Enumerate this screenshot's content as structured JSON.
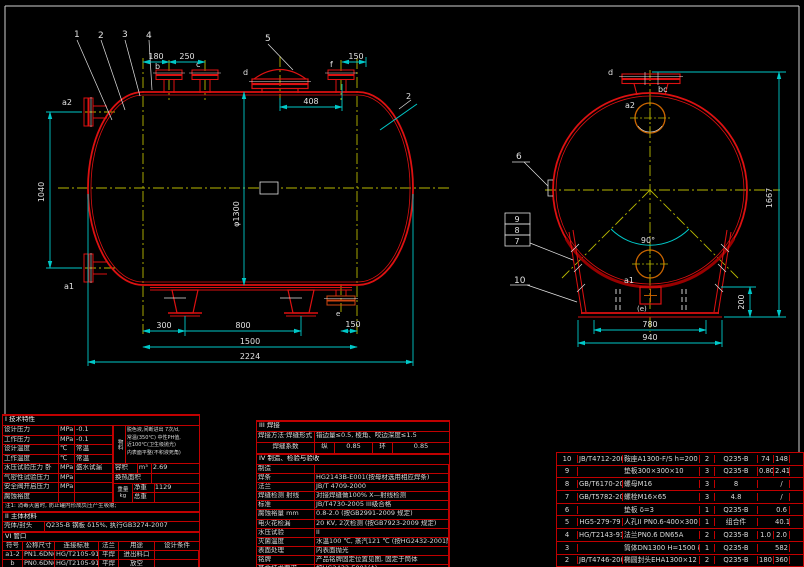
{
  "front": {
    "part_labels": {
      "n1": "1",
      "n2": "2",
      "n3": "3",
      "n4": "4",
      "n5": "5"
    },
    "nozzle_labels": {
      "a2": "a2",
      "a1": "a1",
      "b": "b",
      "c": "c",
      "d": "d",
      "f": "f",
      "e": "e"
    },
    "weld_callout": "2",
    "dims": {
      "top1": "180",
      "top2": "250",
      "mid": "408",
      "top3": "150",
      "left": "1040",
      "dia": "φ1300",
      "bot1": "300",
      "bot2": "800",
      "bot3": "150",
      "bot4": "1500",
      "bot5": "2224"
    }
  },
  "side": {
    "labels": {
      "d": "d",
      "bc": "bc",
      "a2": "a2",
      "a1": "a1",
      "e": "(e)",
      "n6": "6",
      "n7": "7",
      "n8": "8",
      "n9": "9",
      "n10": "10",
      "angle": "90°"
    },
    "dims": {
      "h": "1667",
      "saddle_h": "200",
      "w1": "780",
      "w2": "940"
    }
  },
  "tech": {
    "title": "I 技术特性",
    "rows": [
      {
        "label": "设计压力",
        "unit": "MPa",
        "value": "-0.1"
      },
      {
        "label": "工作压力",
        "unit": "MPa",
        "value": "-0.1"
      },
      {
        "label": "设计温度",
        "unit": "℃",
        "value": "常温"
      },
      {
        "label": "工作温度",
        "unit": "℃",
        "value": "常温"
      },
      {
        "label": "水压试验压力 卧",
        "unit": "MPa",
        "value": "盛水试漏"
      },
      {
        "label": "气密性试验压力",
        "unit": "MPa",
        "value": ""
      },
      {
        "label": "安全阀开启压力",
        "unit": "MPa",
        "value": ""
      },
      {
        "label": "腐蚀裕度",
        "unit": "",
        "value": ""
      }
    ],
    "material_label": "物料",
    "material_lines": [
      "脱色液,间断进出 7次/d,",
      "常温(350℃) 中性PH值,",
      "近100℃(卫生级抛光)",
      "内表面平整(不积液死角)"
    ],
    "volume_label": "容积",
    "volume_unit": "m³",
    "volume_value": "2.69",
    "area_label": "换热面积",
    "area_value": "",
    "weight_label": "重量 kg",
    "net_label": "净重",
    "net_value": "1129",
    "total_label": "总重",
    "total_value": "",
    "note": "注1: 消毒灭菌时, 防止罐内形成负压产生吸瘪;",
    "sec2_title": "II 主体材料",
    "body_label": "壳体/封头",
    "body_value": "Q235-B 钢板 δ15%, 执行GB3274-2007",
    "sec6_title": "VI 管口"
  },
  "nozzles": {
    "headers": [
      "符号",
      "公称尺寸",
      "连接标准",
      "法兰",
      "用途",
      "设计条件"
    ],
    "rows": [
      {
        "sym": "a1-2",
        "size": "PN1.6DN65",
        "std": "HG/T2105-91",
        "face": "平焊",
        "use": "进出料口",
        "note": ""
      },
      {
        "sym": "b",
        "size": "PN0.6DN65",
        "std": "HG/T2105-91",
        "face": "平焊",
        "use": "放空",
        "note": ""
      },
      {
        "sym": "c",
        "size": "PN0.6DN65",
        "std": "HG/T2105-91",
        "face": "平焊",
        "use": "进料",
        "note": ""
      }
    ]
  },
  "fab": {
    "title3": "III 焊接",
    "weld_label": "焊接方法·焊缝形式 mm",
    "weld_value": "错边量≤0.5, 棱角、咬边深度≤1.5",
    "coef_label": "焊缝系数",
    "coef_c1": "纵",
    "coef_v1": "0.85",
    "coef_c2": "环",
    "coef_v2": "0.85",
    "title4": "IV 制造、检验与验收",
    "rows": [
      {
        "label": "制造",
        "value": ""
      },
      {
        "label": "焊条",
        "value": "HG2143B-E001(按母材选用相应焊条)"
      },
      {
        "label": "法兰",
        "value": "JB/T 4709-2000"
      },
      {
        "label": "焊缝检测 射线",
        "value": "对接焊缝做100% X—射线检测"
      },
      {
        "label": "标准",
        "value": "JB/T4730-2005 III级合格"
      },
      {
        "label": "腐蚀裕量 mm",
        "value": "0.8-2.0 (按GB2991-2009 规定)"
      },
      {
        "label": "电火花检漏",
        "value": "20 KV, 2次检测 (按GB7923-2009 规定)"
      },
      {
        "label": "水压试验",
        "value": "II"
      },
      {
        "label": "灭菌温度",
        "value": "水温100 ℃, 蒸汽121 ℃ (按HG2432-2001附录规定)"
      },
      {
        "label": "表面处理",
        "value": "内表面抛光"
      },
      {
        "label": "铭牌",
        "value": "产品铭牌固定位置见图, 固定于筒体"
      },
      {
        "label": "其余技术要求",
        "value": "按HG2432-E001(A)"
      }
    ]
  },
  "bom": {
    "rows": [
      {
        "no": "10",
        "std": "JB/T4712-2007",
        "name": "鞍座A1300-F/S h=200",
        "qty": "2",
        "mat": "Q235-B",
        "w1": "74",
        "w2": "148",
        "note": ""
      },
      {
        "no": "9",
        "std": "",
        "name": "垫板300×300×10",
        "qty": "3",
        "mat": "Q235-B",
        "w1": "0.80",
        "w2": "2.41",
        "note": ""
      },
      {
        "no": "8",
        "std": "GB/T6170-2000",
        "name": "螺母M16",
        "qty": "3",
        "mat": "8",
        "w1": "",
        "w2": "/",
        "note": ""
      },
      {
        "no": "7",
        "std": "GB/T5782-2000",
        "name": "螺栓M16×65",
        "qty": "3",
        "mat": "4.8",
        "w1": "",
        "w2": "/",
        "note": ""
      },
      {
        "no": "6",
        "std": "",
        "name": "垫板 δ=3",
        "qty": "1",
        "mat": "Q235-B",
        "w1": "",
        "w2": "0.6",
        "note": ""
      },
      {
        "no": "5",
        "std": "HG5-279-79",
        "name": "人孔II PN0.6-400×300",
        "qty": "1",
        "mat": "组合件",
        "w1": "",
        "w2": "40.1",
        "note": ""
      },
      {
        "no": "4",
        "std": "HG/T2143-91",
        "name": "法兰PN0.6 DN65A",
        "qty": "2",
        "mat": "Q235-B",
        "w1": "1.0",
        "w2": "2.0",
        "note": ""
      },
      {
        "no": "3",
        "std": "",
        "name": "筒体DN1300 H=1500 δ=12",
        "qty": "1",
        "mat": "Q235-B",
        "w1": "",
        "w2": "582",
        "note": ""
      },
      {
        "no": "2",
        "std": "JB/T4746-2002",
        "name": "椭圆封头EHA1300×12",
        "qty": "2",
        "mat": "Q235-B",
        "w1": "180",
        "w2": "360",
        "note": ""
      }
    ]
  }
}
